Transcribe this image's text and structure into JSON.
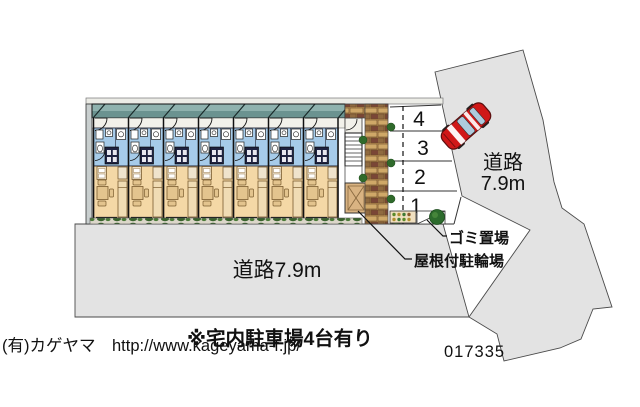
{
  "plan": {
    "parking": {
      "spaces": [
        "4",
        "3",
        "2",
        "1"
      ]
    },
    "roads": {
      "bottom_label": "道路7.9m",
      "right_label_line1": "道路",
      "right_label_line2": "7.9m"
    },
    "annotations": {
      "garbage_label": "ゴミ置場",
      "bicycle_label": "屋根付駐輪場",
      "note": "※宅内駐車場4台有り",
      "plan_number": "017335"
    },
    "watermark": "(有)カゲヤマ　http://www.kageyama-f.jp/",
    "building": {
      "unit_count": 7
    },
    "colors": {
      "road_gray": "#e3e3e3",
      "roof_teal": "#6b9390",
      "bath_blue": "#a6cbe9",
      "living_beige": "#f4d8a6",
      "car_red": "#d01818",
      "tree_green": "#2c6b2c",
      "watermark_gray": "#bdbdbd"
    }
  }
}
